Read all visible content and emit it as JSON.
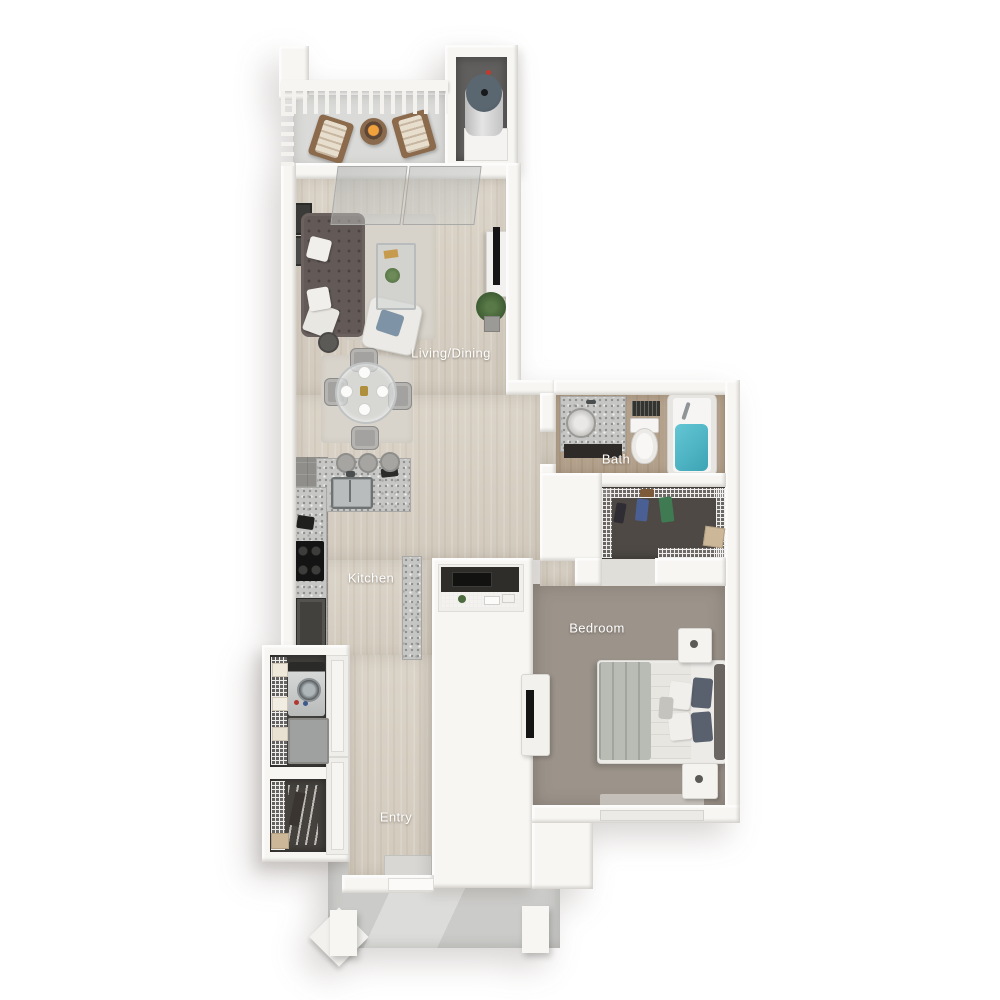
{
  "floorplan": {
    "labels": {
      "living_dining": "Living/Dining",
      "bath": "Bath",
      "kitchen": "Kitchen",
      "bedroom": "Bedroom",
      "entry": "Entry"
    },
    "colors": {
      "background": "#ffffff",
      "wall": "#f7f6f3",
      "wood_floor": "#d8d1c5",
      "bedroom_carpet": "#9c948b",
      "closet_carpet": "#4e4944",
      "kitchen_tile": "#8f8e8a",
      "bath_floor": "#b4a18c",
      "balcony_concrete": "#dadad8",
      "porch_concrete": "#cbcbc9",
      "granite_counter": "#c6c6c4",
      "sofa": "#5f5755",
      "accent_pillow": "#7e93a5",
      "tub_water": "#4cb5c5",
      "appliance_dark": "#1e1e1c",
      "label_text": "#ffffff"
    },
    "furniture_icons": [
      "sofa",
      "ottoman",
      "side-table",
      "coffee-table",
      "accent-chair",
      "tv-console",
      "flat-tv",
      "potted-plant",
      "wall-art",
      "area-rug",
      "dining-table",
      "dining-chair",
      "bar-stool",
      "kitchen-sink",
      "stove",
      "dishwasher",
      "desk-nook",
      "bathroom-vanity",
      "toilet",
      "bathtub",
      "vent",
      "walk-in-closet-shelving",
      "hanging-clothes",
      "storage-box",
      "bed",
      "headboard",
      "bed-pillow",
      "nightstand",
      "dresser-tv",
      "washer-dryer",
      "towel-shelf",
      "coat-closet",
      "closet-doors",
      "door-mat",
      "entry-door",
      "porch-post",
      "balcony-railing",
      "deck-chair",
      "fire-table",
      "water-heater",
      "sliding-glass-door"
    ]
  }
}
